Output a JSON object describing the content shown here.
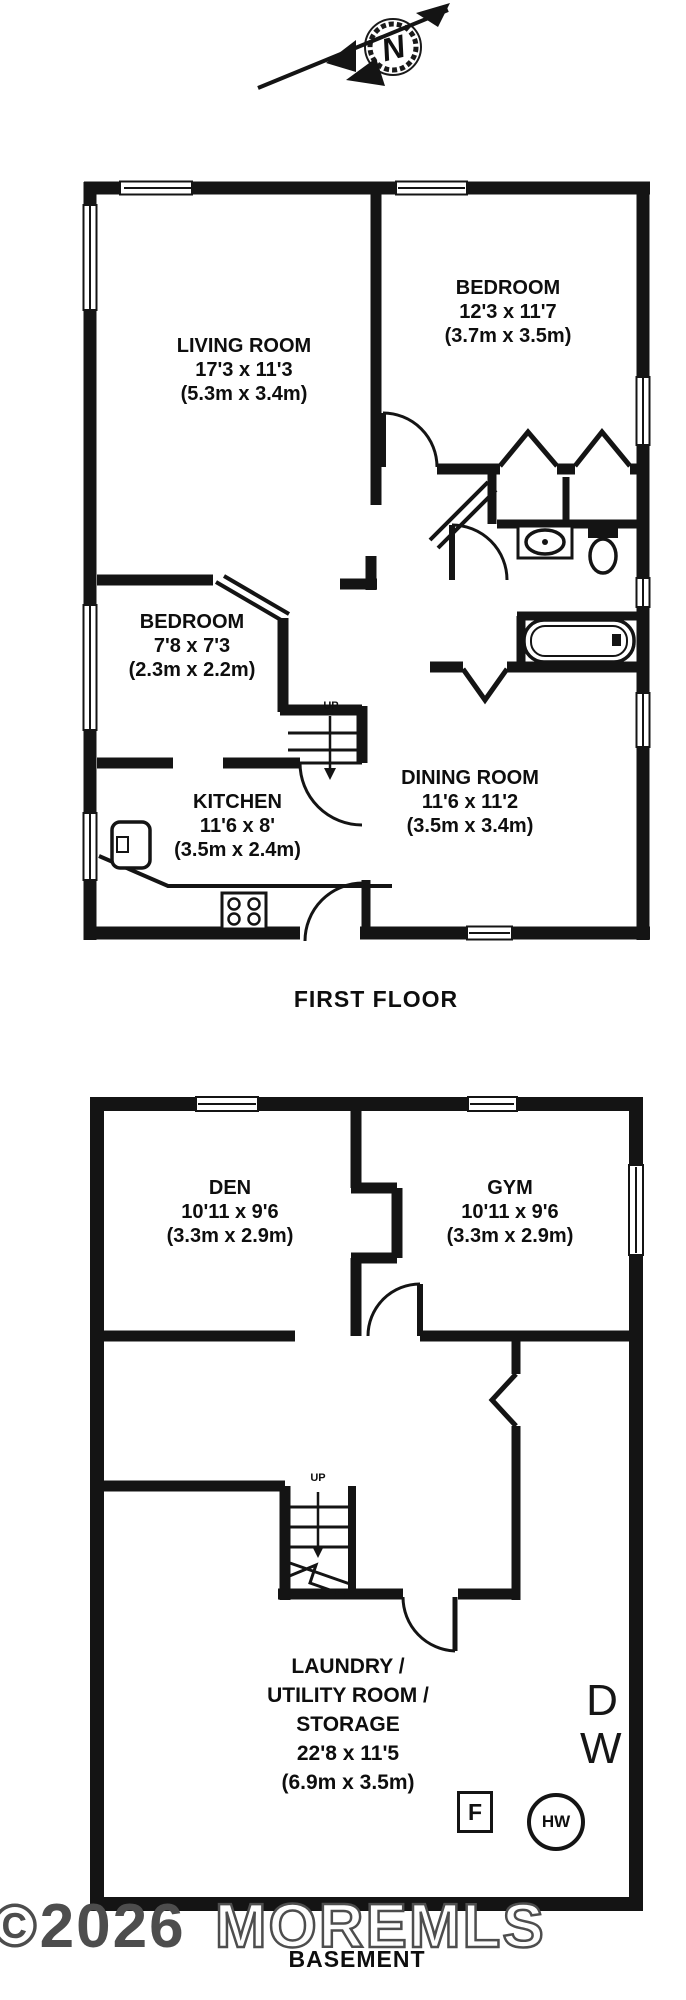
{
  "compass": {
    "direction_label": "N"
  },
  "first_floor": {
    "title": "FIRST FLOOR",
    "stairs_label": "UP",
    "rooms": {
      "living_room": {
        "name": "LIVING ROOM",
        "dims_ft": "17'3 x 11'3",
        "dims_m": "(5.3m x 3.4m)"
      },
      "bedroom_main": {
        "name": "BEDROOM",
        "dims_ft": "12'3 x 11'7",
        "dims_m": "(3.7m x 3.5m)"
      },
      "bedroom_small": {
        "name": "BEDROOM",
        "dims_ft": "7'8 x 7'3",
        "dims_m": "(2.3m x 2.2m)"
      },
      "kitchen": {
        "name": "KITCHEN",
        "dims_ft": "11'6 x 8'",
        "dims_m": "(3.5m x 2.4m)"
      },
      "dining_room": {
        "name": "DINING ROOM",
        "dims_ft": "11'6 x 11'2",
        "dims_m": "(3.5m x 3.4m)"
      }
    }
  },
  "basement": {
    "title": "BASEMENT",
    "stairs_label": "UP",
    "rooms": {
      "den": {
        "name": "DEN",
        "dims_ft": "10'11 x 9'6",
        "dims_m": "(3.3m x 2.9m)"
      },
      "gym": {
        "name": "GYM",
        "dims_ft": "10'11 x 9'6",
        "dims_m": "(3.3m x 2.9m)"
      },
      "laundry": {
        "name_line1": "LAUNDRY /",
        "name_line2": "UTILITY ROOM /",
        "name_line3": "STORAGE",
        "dims_ft": "22'8 x 11'5",
        "dims_m": "(6.9m x 3.5m)"
      }
    },
    "appliances": {
      "dryer": "D",
      "washer": "W",
      "furnace": "F",
      "hot_water_heater": "HW"
    }
  },
  "watermark": {
    "prefix": "©2026",
    "name": "MOREMLS"
  },
  "colors": {
    "wall": "#141414",
    "background": "#ffffff"
  }
}
